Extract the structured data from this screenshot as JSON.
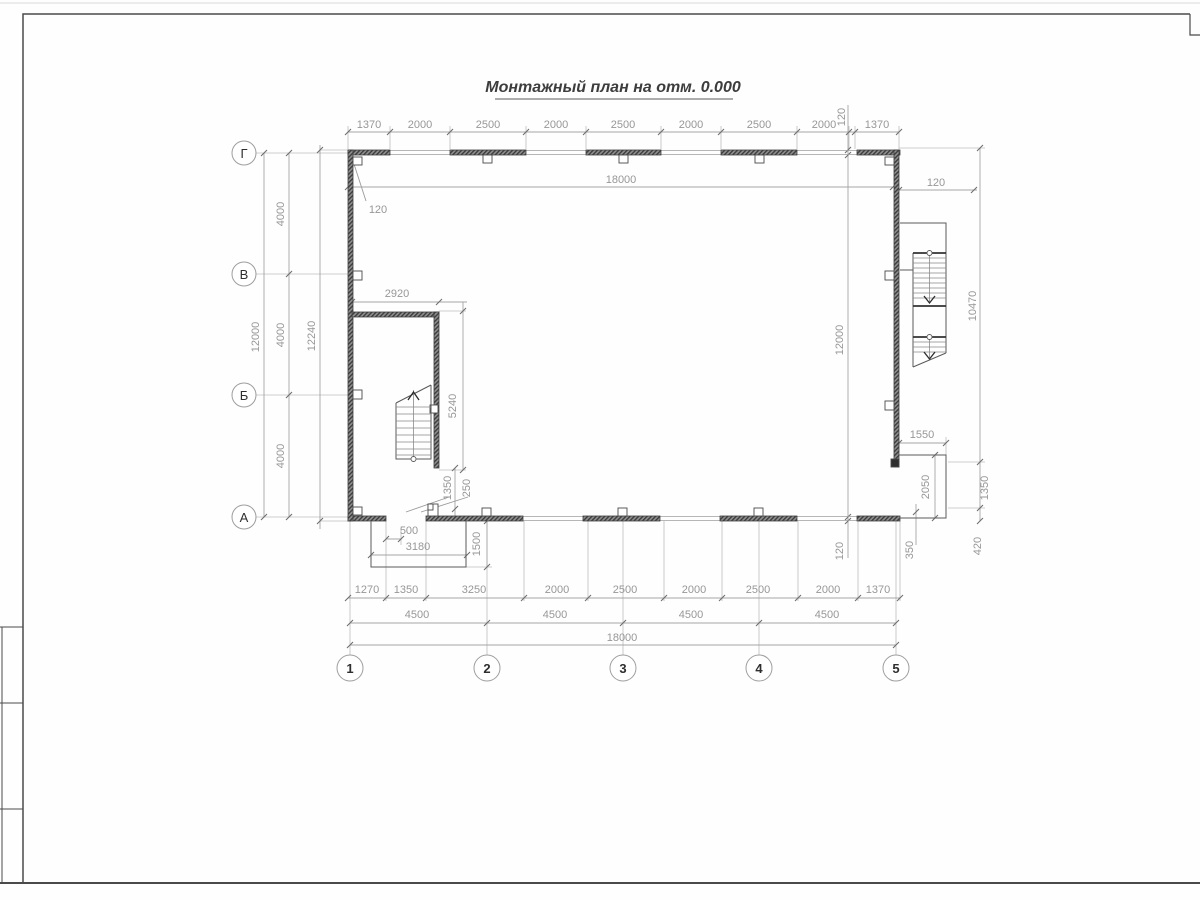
{
  "title": "Монтажный план на отм. 0.000",
  "axes": {
    "cols": [
      "1",
      "2",
      "3",
      "4",
      "5"
    ],
    "rows": [
      "Г",
      "В",
      "Б",
      "А"
    ]
  },
  "dims": {
    "top": [
      "1370",
      "2000",
      "2500",
      "2000",
      "2500",
      "2000",
      "2500",
      "2000",
      "120",
      "1370"
    ],
    "top_total": "18000",
    "top_right_offset": "120",
    "wall_thickness_leader": "120",
    "left": {
      "total": "12000",
      "spans": [
        "4000",
        "4000",
        "4000"
      ],
      "outer": "12240"
    },
    "right": {
      "total": "12000",
      "offset_bottom": "120",
      "outer": "10470",
      "seg_a": "1350",
      "seg_b": "420",
      "landing_width": "1550",
      "landing_depth": "2050",
      "offset": "350"
    },
    "stairwell": {
      "width": "2920",
      "depth": "5240",
      "d_a": "1350",
      "d_b": "250"
    },
    "porch": {
      "offset": "500",
      "width": "3180",
      "depth": "1500"
    },
    "bottom_segments": [
      "1270",
      "1350",
      "3250",
      "2000",
      "2500",
      "2000",
      "2500",
      "2000",
      "1370"
    ],
    "bottom_spans": [
      "4500",
      "4500",
      "4500",
      "4500"
    ],
    "bottom_total": "18000"
  }
}
